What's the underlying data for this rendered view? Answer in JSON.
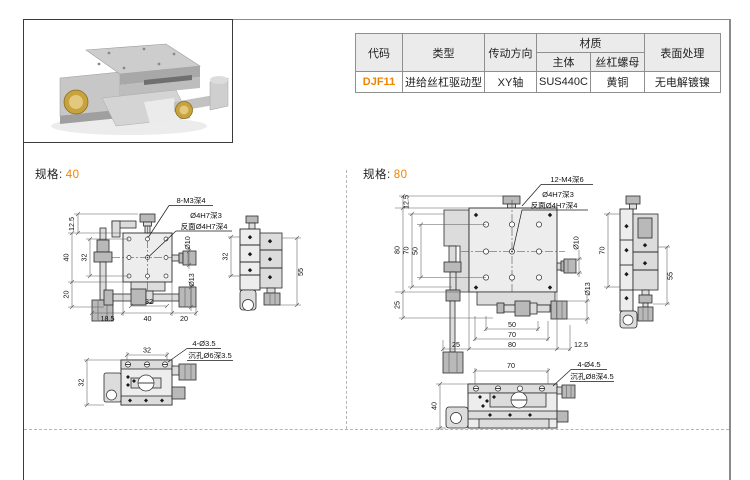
{
  "accent_color": "#f08300",
  "table": {
    "headers": {
      "code": "代码",
      "type": "类型",
      "direction": "传动方向",
      "material": "材质",
      "body": "主体",
      "nut": "丝杠螺母",
      "surface": "表面处理"
    },
    "row": {
      "code": "DJF11",
      "type": "进给丝杠驱动型",
      "direction": "XY轴",
      "body": "SUS440C",
      "nut": "黄铜",
      "surface": "无电解镀镍"
    }
  },
  "specs": {
    "s40": {
      "label": "规格:",
      "size": "40",
      "callout_holes": "8-M3深4",
      "callout_hole": "Ø4H7深3",
      "callout_back": "反面Ø4H7深4",
      "left_dims": [
        "12.5",
        "40",
        "32",
        "20"
      ],
      "bottom_dims": [
        "18.5",
        "40",
        "20"
      ],
      "bottom_inner": "32",
      "dia_top": "Ø10",
      "dia_bottom": "Ø13",
      "side_left": "32",
      "side_right": "55",
      "bottom_view": {
        "top": "32",
        "left": "32",
        "callout_holes": "4-Ø3.5",
        "callout_cbore": "沉孔Ø6深3.5"
      }
    },
    "s80": {
      "label": "规格:",
      "size": "80",
      "callout_holes": "12-M4深6",
      "callout_hole": "Ø4H7深3",
      "callout_back": "反面Ø4H7深4",
      "left_dims": [
        "12.5",
        "80",
        "70",
        "50",
        "25"
      ],
      "bottom_dims": [
        "50",
        "70",
        "80",
        "25",
        "12.5"
      ],
      "dia_top": "Ø10",
      "dia_bottom": "Ø13",
      "side_left": "70",
      "side_right": "55",
      "bottom_view": {
        "top": "70",
        "left": "40",
        "callout_holes": "4-Ø4.5",
        "callout_cbore": "沉孔Ø8深4.5"
      }
    }
  }
}
